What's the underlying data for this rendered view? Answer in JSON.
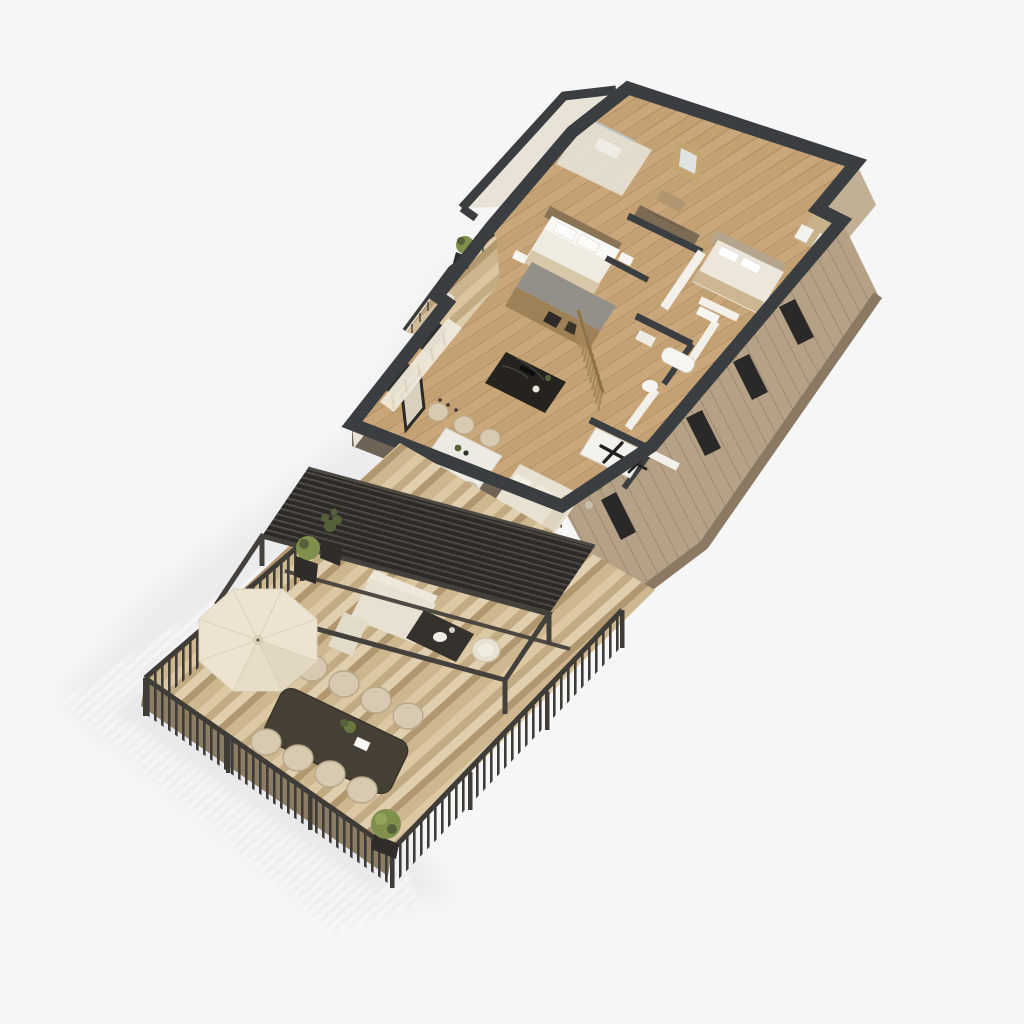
{
  "meta": {
    "title": "3D isometric cutaway floor plan render of an apartment with roof terrace",
    "style": "photoreal architectural visualization, top-down axonometric, studio white background",
    "visible_text": "none"
  },
  "colors": {
    "bg": "#f6f6f7",
    "shadowSoft": "#e7e7ea",
    "shadowStripe": "#d9d9de",
    "shadowFill": "#ededf0",
    "wallTop": "#3b3e41",
    "wallWhite": "#f3f0e9",
    "wallCream": "#e9e3d7",
    "wallCreamDark": "#e2dbcd",
    "facadeWood": "#b5a286",
    "facadeWoodLine": "#9c8a70",
    "facadeWoodLight": "#c2b096",
    "facadeEdge": "#8b7963",
    "facadeWindow": "#2b2927",
    "floorWood": "#c9a77a",
    "floorWoodMid": "#c4a173",
    "floorWoodLine": "#b08c5e",
    "deck1": "#dcc9a4",
    "deck2": "#c2ab82",
    "deck3": "#e0cfae",
    "deck4": "#b1976f",
    "deck5": "#cdb78f",
    "deckEdge": "#8d7c64",
    "railDark": "#3f3c38",
    "pergolaDark": "#2c2a27",
    "pergolaLine": "#46433e",
    "frameMetal": "#44413c",
    "umbrella": "#ece4d1",
    "umbrellaShade": "#e2d8c2",
    "umbrellaSeam": "#dcd2ba",
    "cream": "#e8e0d0",
    "creamLight": "#f0ebe1",
    "chairBeige": "#d8cab1",
    "chairRim": "#b6a78a",
    "chairSeat": "#e8ddc8",
    "outdoorTable": "#453f36",
    "marbleTable": "#eceae3",
    "islandDark": "#26231f",
    "kitchenWood": "#9f8157",
    "counterGray": "#93908a",
    "slatWood": "#a8885c",
    "headboardWood": "#8a7456",
    "wardrobeWood": "#7c6b54",
    "bedThrow": "#d8c7a9",
    "green": "#7f904c",
    "greenDark": "#55613a",
    "planter": "#2f2c29",
    "white": "#f7f5f1",
    "fanX": "#232220"
  },
  "scene": {
    "building": {
      "rooms": [
        {
          "name": "entry-vestibule"
        },
        {
          "name": "bathroom-with-shower"
        },
        {
          "name": "master-bedroom"
        },
        {
          "name": "hallway"
        },
        {
          "name": "bedroom-2",
          "features": [
            "recessed-balcony-with-railing"
          ]
        },
        {
          "name": "bathroom-2",
          "features": [
            "bathtub",
            "wc",
            "vanity"
          ]
        },
        {
          "name": "laundry-room",
          "features": [
            "two-appliances-with-x-latches"
          ]
        },
        {
          "name": "kitchen",
          "features": [
            "tall-wood-cabinets",
            "dark-marble-island",
            "wood-slat-screen"
          ]
        },
        {
          "name": "dining-area",
          "features": [
            "marble-table",
            "six-chairs",
            "framed-art"
          ]
        },
        {
          "name": "living-area",
          "features": [
            "cream-sofa"
          ]
        },
        {
          "name": "nw-balcony",
          "features": [
            "railing",
            "potted-plant",
            "lounge-chair"
          ]
        }
      ],
      "exterior": [
        "charcoal-cut-wall-tops",
        "cream-upper-walls",
        "wood-plank-facade",
        "tall-dark-window-recesses"
      ]
    },
    "terrace": {
      "features": [
        "diagonal-wood-deck-planks",
        "black-slat-railing",
        "louvered-pergola-roof",
        "open-pergola-frame",
        "octagonal-cream-parasol",
        "long-outdoor-dining-table",
        "eight-beige-dining-chairs",
        "outdoor-lounge-sofa-set",
        "dark-coffee-table",
        "boxwood-topiary-planters"
      ]
    },
    "lighting": "soft daylight from upper right, striped railing shadow cast to lower left"
  }
}
